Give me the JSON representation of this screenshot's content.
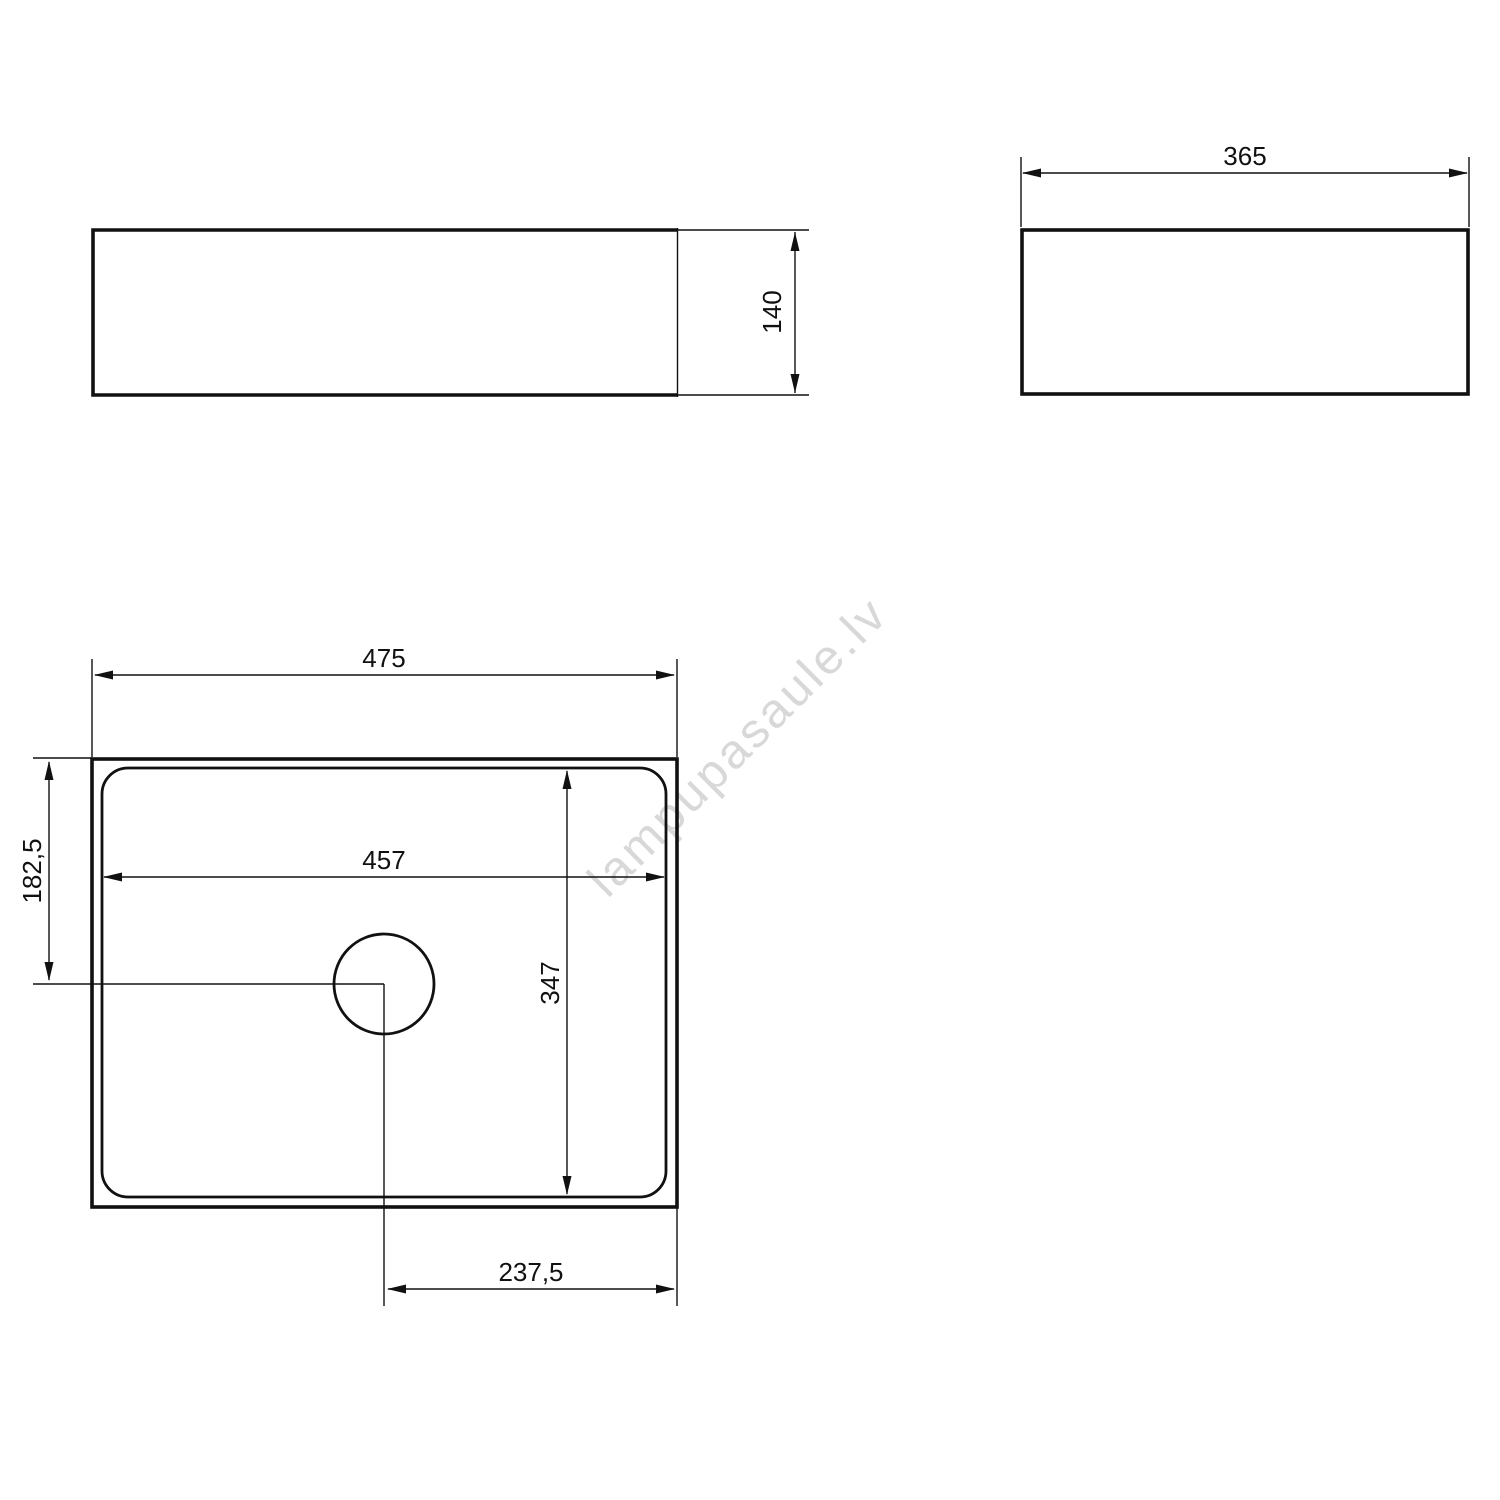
{
  "watermark": {
    "text": "lampupasaule.lv",
    "color": "#d8d8d8",
    "angle_deg": -45
  },
  "colors": {
    "background": "#ffffff",
    "line": "#111111"
  },
  "views": {
    "front": {
      "dims": {
        "height": {
          "value": "140",
          "orientation": "vertical"
        }
      }
    },
    "side": {
      "dims": {
        "width": {
          "value": "365",
          "orientation": "horizontal"
        }
      }
    },
    "plan": {
      "dims": {
        "overall_width": {
          "value": "475",
          "orientation": "horizontal"
        },
        "basin_width": {
          "value": "457",
          "orientation": "horizontal"
        },
        "basin_depth": {
          "value": "347",
          "orientation": "vertical"
        },
        "drain_center_from_top": {
          "value": "182,5",
          "orientation": "vertical"
        },
        "drain_center_from_right": {
          "value": "237,5",
          "orientation": "horizontal"
        }
      }
    }
  }
}
